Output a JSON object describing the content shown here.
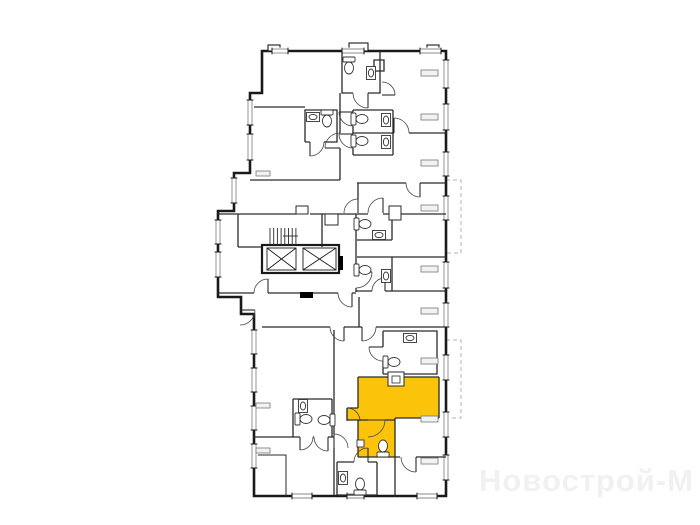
{
  "watermark": {
    "text": "Новострой-М"
  },
  "colors": {
    "background": "#ffffff",
    "walls": "#1a1a1a",
    "interior_walls": "#2a2a2a",
    "highlight": "#fcc30b",
    "window_glass": "#8a8a8a",
    "balcony_dash": "#b3b3b3",
    "watermark": "#f1f1f1"
  }
}
